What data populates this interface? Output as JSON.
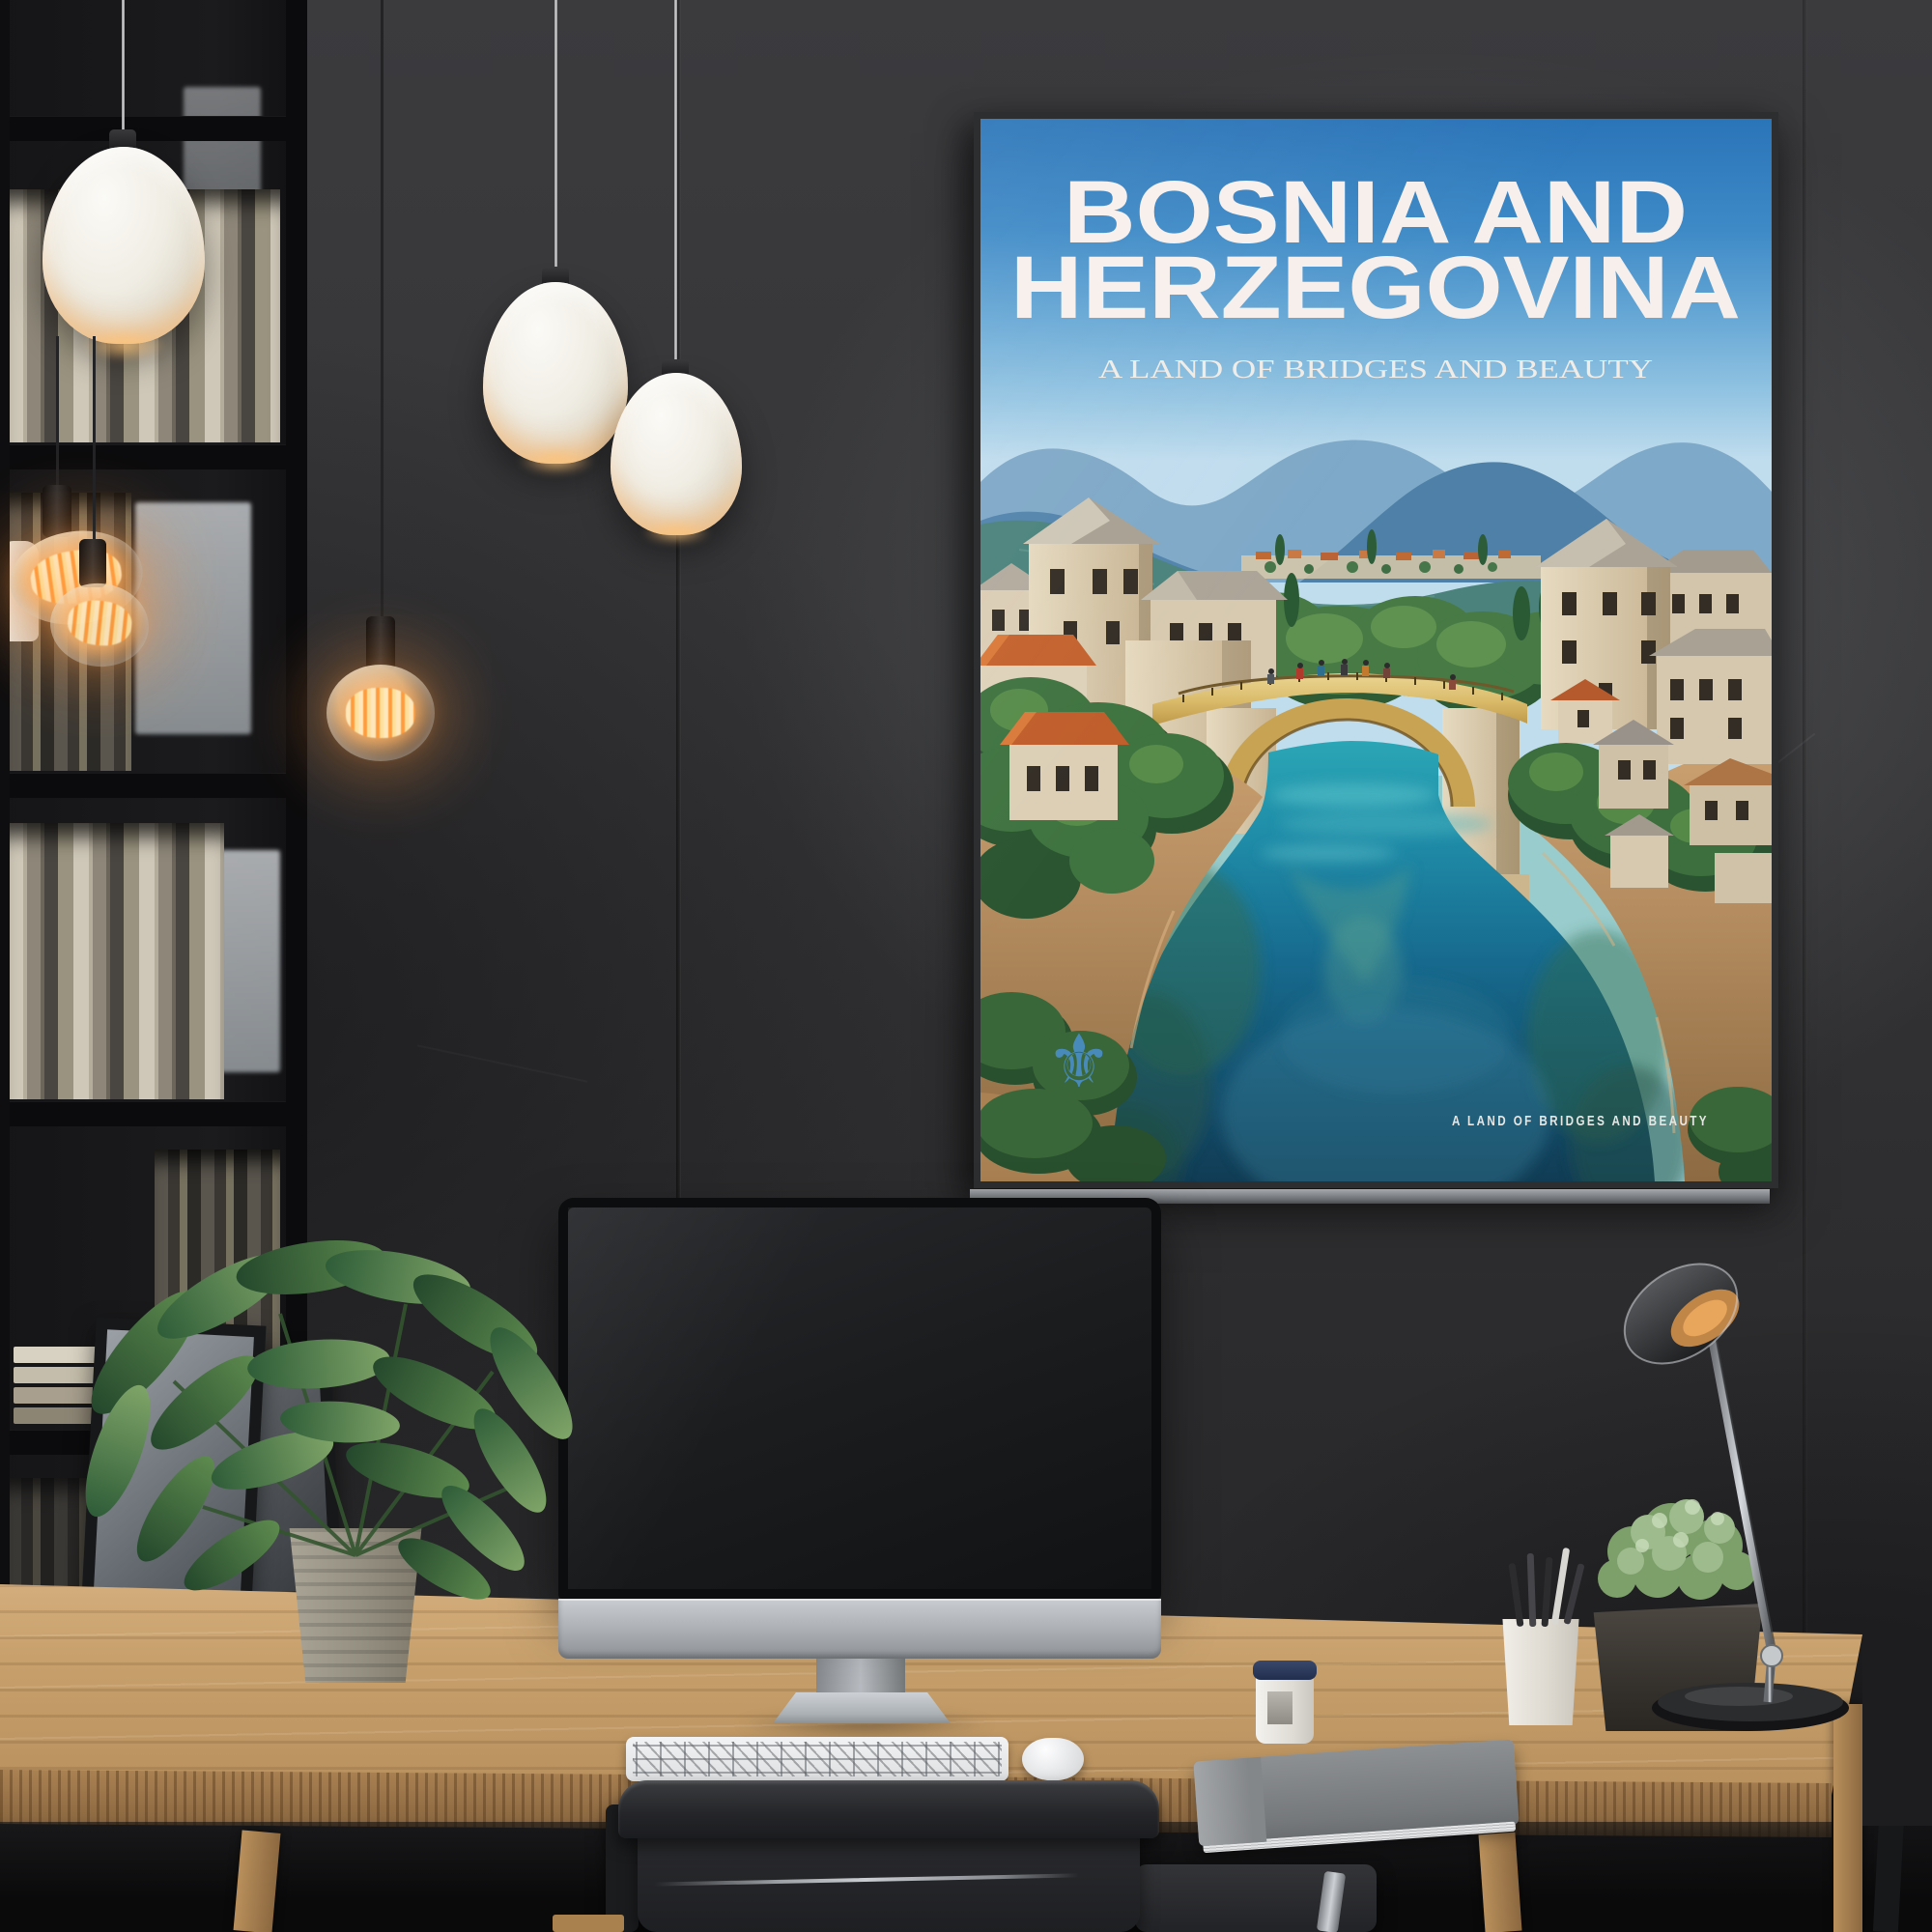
{
  "poster": {
    "title_line1": "BOSNIA AND",
    "title_line2": "HERZEGOVINA",
    "subtitle": "A LAND OF BRIDGES AND BEAUTY",
    "caption": "A LAND OF BRIDGES AND BEAUTY",
    "emblem": {
      "icon": "fleur-de-lis-icon",
      "glyph": "⚜",
      "color": "#4a8fc6"
    },
    "colors": {
      "sky_top": "#2a74b8",
      "sky_horizon": "#c0ddee",
      "mountain_far": "#7fa9c8",
      "mountain_mid": "#4e80a8",
      "mountain_green": "#4b837c",
      "stone": "#e0d3b9",
      "roof_gray": "#aba496",
      "roof_orange": "#c4622e",
      "bridge_gold": "#d9ba69",
      "river_teal": "#1f8ca8",
      "river_deep": "#113c55",
      "tree_green": "#3f7340",
      "title_text": "#f7efec"
    }
  },
  "room": {
    "objects": [
      "bookshelf",
      "pendant-lamp",
      "edison-bulb-pendant",
      "travel-poster",
      "imac-monitor",
      "keyboard",
      "mouse",
      "potted-plant",
      "wood-desk",
      "office-chair",
      "desk-lamp",
      "notebook",
      "coffee-cup",
      "pen-cup",
      "planter-box",
      "leaning-frames"
    ],
    "colors": {
      "wall": "#343436",
      "desk_wood": "#c7a06c",
      "chair": "#232427",
      "monitor_silver": "#b7bbc0"
    }
  }
}
